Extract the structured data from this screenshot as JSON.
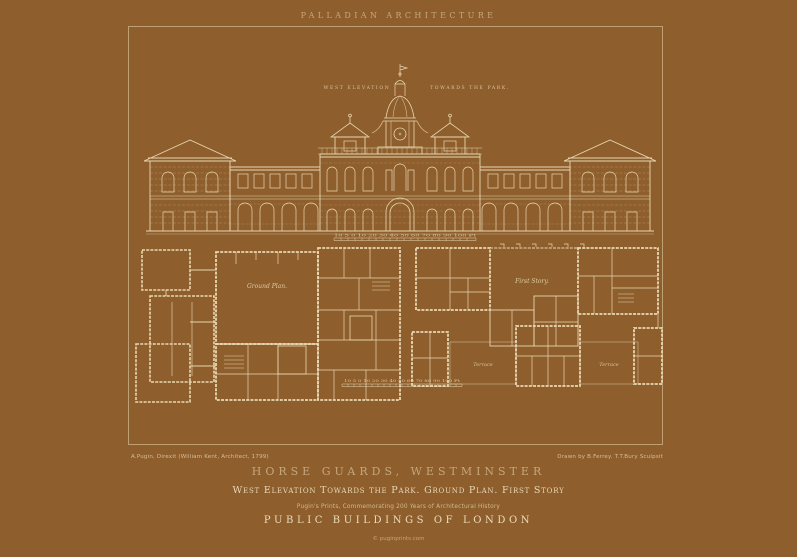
{
  "colors": {
    "background": "#8e5e2c",
    "ink": "#e9d7b2",
    "muted_ink": "#bb9c6c",
    "frame_line": "#e7d5b0"
  },
  "header": {
    "series_title": "PALLADIAN ARCHITECTURE"
  },
  "plate": {
    "elevation": {
      "label_left": "WEST ELEVATION",
      "label_right": "TOWARDS THE PARK.",
      "scale": "10 5 0 10 20 30 40 50 60 70 80 90 100 Ft"
    },
    "plans": {
      "ground_plan_label": "Ground Plan.",
      "first_story_label": "First Story.",
      "terrace_left_label": "Terrace",
      "terrace_right_label": "Terrace",
      "scale": "10 5 0 10 20 30 40 50 60 70 80 90 100 Ft"
    }
  },
  "credits": {
    "left": "A.Pugin, Direxit (William Kent, Architect, 1799)",
    "right": "Drawn by B.Ferrey. T.T.Bury Sculpsit"
  },
  "footer": {
    "title": "HORSE GUARDS, WESTMINSTER",
    "subtitle": "West Elevation Towards the Park. Ground Plan. First Story",
    "note": "Pugin's Prints, Commemorating 200 Years of Architectural History",
    "series": "PUBLIC BUILDINGS OF LONDON",
    "copyright": "© puginprints.com"
  }
}
